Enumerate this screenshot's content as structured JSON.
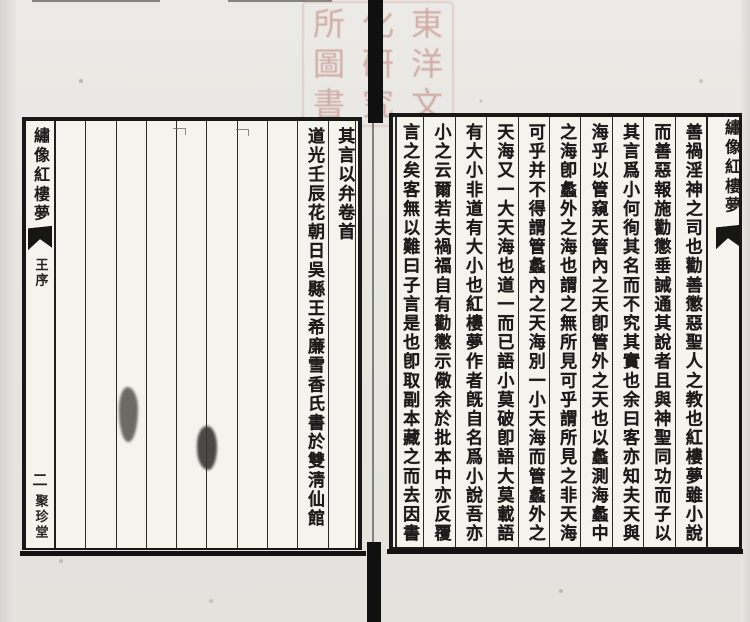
{
  "ink_color": "#1c1b19",
  "paper_color": "#f5f3ee",
  "seal": {
    "color": "#b97b72",
    "characters": [
      "東",
      "洋",
      "文",
      "化",
      "研",
      "究",
      "所",
      "圖",
      "書"
    ]
  },
  "right_page": {
    "banxin": {
      "title": "繡像紅樓夢"
    },
    "text_columns": [
      "善禍淫神之司也勸善懲惡聖人之教也紅樓夢雖小說",
      "而善惡報施勸懲垂誡通其說者且與神聖同功而子以",
      "其言爲小何徇其名而不究其實也余曰客亦知夫天與",
      "海乎以管窺天管內之天卽管外之天也以蠡測海蠡中",
      "之海卽蠡外之海也謂之無所見可乎謂所見之非天海",
      "可乎并不得謂管蠡內之天海別一小天海而管蠡外之",
      "天海又一大天海也道一而已語小莫破卽語大莫載語",
      "有大小非道有大小也紅樓夢作者旣自名爲小說吾亦",
      "小之云爾若夫禍福自有勸懲示儆余於批本中亦反覆",
      "言之矣客無以難曰子言是也卽取副本藏之而去因書"
    ]
  },
  "left_page": {
    "banxin": {
      "title": "繡像紅樓夢",
      "section": "王序",
      "page_number": "二",
      "publisher": "聚珍堂"
    },
    "text_columns": [
      "其言以弁卷首",
      "道光壬辰花朝日吳縣王希廉雪香氏書於雙淸仙館"
    ]
  }
}
